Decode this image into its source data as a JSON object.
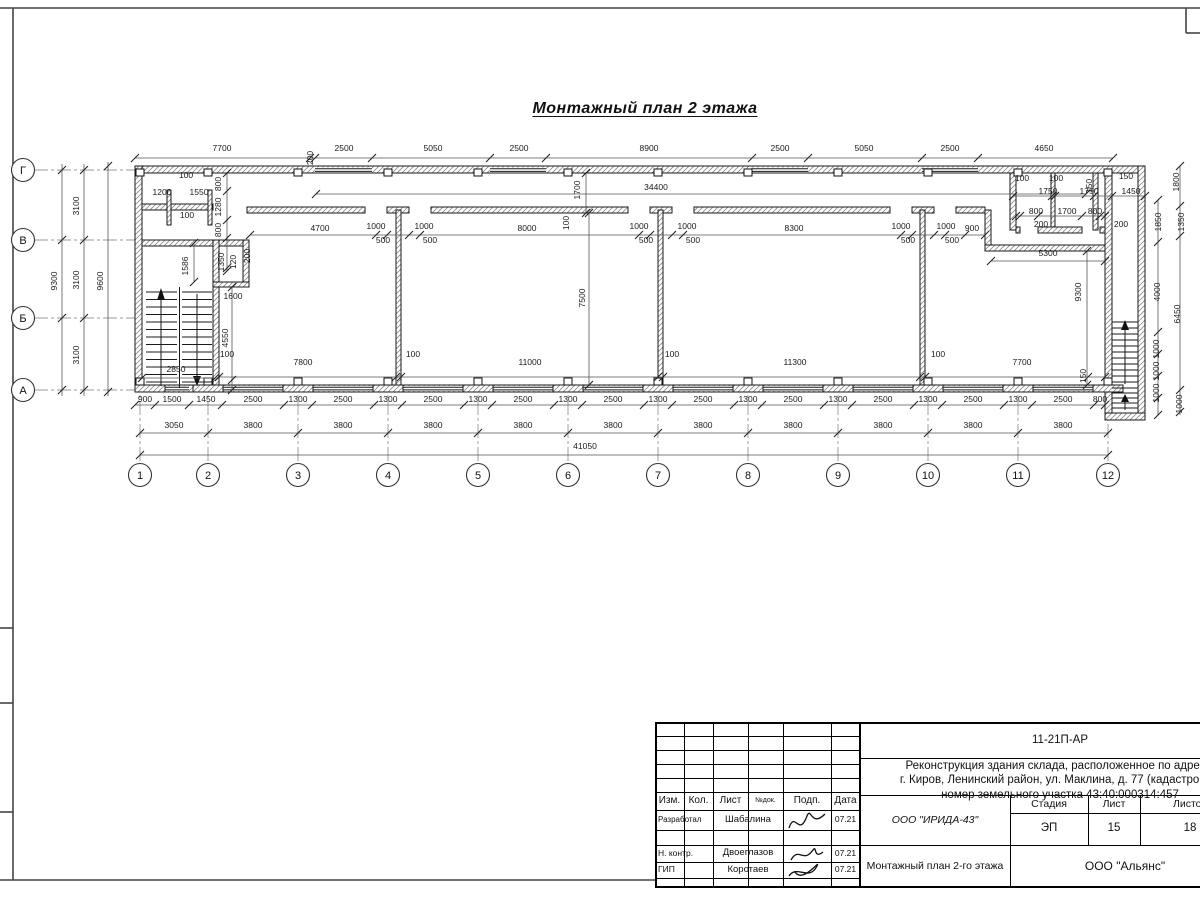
{
  "page": {
    "plan_title": "Монтажный план 2 этажа"
  },
  "plan": {
    "col_axes": [
      {
        "label": "1",
        "x": 140
      },
      {
        "label": "2",
        "x": 208
      },
      {
        "label": "3",
        "x": 298
      },
      {
        "label": "4",
        "x": 388
      },
      {
        "label": "5",
        "x": 478
      },
      {
        "label": "6",
        "x": 568
      },
      {
        "label": "7",
        "x": 658
      },
      {
        "label": "8",
        "x": 748
      },
      {
        "label": "9",
        "x": 838
      },
      {
        "label": "10",
        "x": 928
      },
      {
        "label": "11",
        "x": 1018
      },
      {
        "label": "12",
        "x": 1108
      }
    ],
    "row_axes": [
      {
        "label": "Г",
        "y": 170
      },
      {
        "label": "В",
        "y": 240
      },
      {
        "label": "Б",
        "y": 318
      },
      {
        "label": "А",
        "y": 390
      }
    ],
    "dims": [
      {
        "t": "7700",
        "x": 222,
        "y": 151
      },
      {
        "t": "200",
        "x": 313,
        "y": 158,
        "r": 1
      },
      {
        "t": "2500",
        "x": 344,
        "y": 151
      },
      {
        "t": "5050",
        "x": 433,
        "y": 151
      },
      {
        "t": "2500",
        "x": 519,
        "y": 151
      },
      {
        "t": "8900",
        "x": 649,
        "y": 151
      },
      {
        "t": "2500",
        "x": 780,
        "y": 151
      },
      {
        "t": "5050",
        "x": 864,
        "y": 151
      },
      {
        "t": "2500",
        "x": 950,
        "y": 151
      },
      {
        "t": "4650",
        "x": 1044,
        "y": 151
      },
      {
        "t": "34400",
        "x": 656,
        "y": 190
      },
      {
        "t": "1700",
        "x": 580,
        "y": 190,
        "r": 1
      },
      {
        "t": "100",
        "x": 569,
        "y": 223,
        "r": 1
      },
      {
        "t": "100",
        "x": 186,
        "y": 178
      },
      {
        "t": "1200",
        "x": 162,
        "y": 195
      },
      {
        "t": "1550",
        "x": 199,
        "y": 195
      },
      {
        "t": "100",
        "x": 187,
        "y": 218
      },
      {
        "t": "800",
        "x": 221,
        "y": 184,
        "r": 1
      },
      {
        "t": "1280",
        "x": 221,
        "y": 207,
        "r": 1
      },
      {
        "t": "800",
        "x": 221,
        "y": 230,
        "r": 1
      },
      {
        "t": "1350",
        "x": 224,
        "y": 262,
        "r": 1
      },
      {
        "t": "120",
        "x": 236,
        "y": 262,
        "r": 1
      },
      {
        "t": "200",
        "x": 250,
        "y": 256,
        "r": 1
      },
      {
        "t": "1586",
        "x": 188,
        "y": 266,
        "r": 1
      },
      {
        "t": "1600",
        "x": 233,
        "y": 299
      },
      {
        "t": "4550",
        "x": 228,
        "y": 338,
        "r": 1
      },
      {
        "t": "100",
        "x": 227,
        "y": 357
      },
      {
        "t": "2850",
        "x": 176,
        "y": 372
      },
      {
        "t": "4700",
        "x": 320,
        "y": 231
      },
      {
        "t": "1000",
        "x": 376,
        "y": 229
      },
      {
        "t": "500",
        "x": 383,
        "y": 243
      },
      {
        "t": "1000",
        "x": 424,
        "y": 229
      },
      {
        "t": "500",
        "x": 430,
        "y": 243
      },
      {
        "t": "8000",
        "x": 527,
        "y": 231
      },
      {
        "t": "1000",
        "x": 639,
        "y": 229
      },
      {
        "t": "500",
        "x": 646,
        "y": 243
      },
      {
        "t": "1000",
        "x": 687,
        "y": 229
      },
      {
        "t": "500",
        "x": 693,
        "y": 243
      },
      {
        "t": "8300",
        "x": 794,
        "y": 231
      },
      {
        "t": "1000",
        "x": 901,
        "y": 229
      },
      {
        "t": "500",
        "x": 908,
        "y": 243
      },
      {
        "t": "1000",
        "x": 946,
        "y": 229
      },
      {
        "t": "900",
        "x": 972,
        "y": 231
      },
      {
        "t": "500",
        "x": 952,
        "y": 243
      },
      {
        "t": "100",
        "x": 1022,
        "y": 181
      },
      {
        "t": "100",
        "x": 1056,
        "y": 181
      },
      {
        "t": "150",
        "x": 1092,
        "y": 186,
        "r": 1
      },
      {
        "t": "150",
        "x": 1126,
        "y": 179
      },
      {
        "t": "1750",
        "x": 1048,
        "y": 194
      },
      {
        "t": "1750",
        "x": 1089,
        "y": 194
      },
      {
        "t": "1450",
        "x": 1131,
        "y": 194
      },
      {
        "t": "800",
        "x": 1036,
        "y": 214
      },
      {
        "t": "1700",
        "x": 1067,
        "y": 214
      },
      {
        "t": "800",
        "x": 1095,
        "y": 214
      },
      {
        "t": "200",
        "x": 1041,
        "y": 227
      },
      {
        "t": "200",
        "x": 1121,
        "y": 227
      },
      {
        "t": "1800",
        "x": 1179,
        "y": 182,
        "r": 1
      },
      {
        "t": "1350",
        "x": 1184,
        "y": 222,
        "r": 1
      },
      {
        "t": "1850",
        "x": 1161,
        "y": 222,
        "r": 1
      },
      {
        "t": "4000",
        "x": 1160,
        "y": 292,
        "r": 1
      },
      {
        "t": "6450",
        "x": 1180,
        "y": 314,
        "r": 1
      },
      {
        "t": "1000",
        "x": 1159,
        "y": 349,
        "r": 1
      },
      {
        "t": "1000",
        "x": 1159,
        "y": 371,
        "r": 1
      },
      {
        "t": "1000",
        "x": 1159,
        "y": 393,
        "r": 1
      },
      {
        "t": "1000",
        "x": 1182,
        "y": 404,
        "r": 1
      },
      {
        "t": "5300",
        "x": 1048,
        "y": 256
      },
      {
        "t": "9300",
        "x": 1081,
        "y": 292,
        "r": 1
      },
      {
        "t": "150",
        "x": 1086,
        "y": 376,
        "r": 1
      },
      {
        "t": "7800",
        "x": 303,
        "y": 365
      },
      {
        "t": "100",
        "x": 413,
        "y": 357
      },
      {
        "t": "11000",
        "x": 530,
        "y": 365
      },
      {
        "t": "100",
        "x": 672,
        "y": 357
      },
      {
        "t": "11300",
        "x": 795,
        "y": 365
      },
      {
        "t": "100",
        "x": 938,
        "y": 357
      },
      {
        "t": "7700",
        "x": 1022,
        "y": 365
      },
      {
        "t": "7500",
        "x": 585,
        "y": 298,
        "r": 1
      },
      {
        "t": "9300",
        "x": 57,
        "y": 281,
        "r": 1
      },
      {
        "t": "3100",
        "x": 79,
        "y": 206,
        "r": 1
      },
      {
        "t": "3100",
        "x": 79,
        "y": 280,
        "r": 1
      },
      {
        "t": "3100",
        "x": 79,
        "y": 355,
        "r": 1
      },
      {
        "t": "9600",
        "x": 103,
        "y": 281,
        "r": 1
      },
      {
        "t": "900",
        "x": 145,
        "y": 402
      },
      {
        "t": "1500",
        "x": 172,
        "y": 402
      },
      {
        "t": "1450",
        "x": 206,
        "y": 402
      },
      {
        "t": "2500",
        "x": 253,
        "y": 402
      },
      {
        "t": "1300",
        "x": 298,
        "y": 402
      },
      {
        "t": "2500",
        "x": 343,
        "y": 402
      },
      {
        "t": "1300",
        "x": 388,
        "y": 402
      },
      {
        "t": "2500",
        "x": 433,
        "y": 402
      },
      {
        "t": "1300",
        "x": 478,
        "y": 402
      },
      {
        "t": "2500",
        "x": 523,
        "y": 402
      },
      {
        "t": "1300",
        "x": 568,
        "y": 402
      },
      {
        "t": "2500",
        "x": 613,
        "y": 402
      },
      {
        "t": "1300",
        "x": 658,
        "y": 402
      },
      {
        "t": "2500",
        "x": 703,
        "y": 402
      },
      {
        "t": "1300",
        "x": 748,
        "y": 402
      },
      {
        "t": "2500",
        "x": 793,
        "y": 402
      },
      {
        "t": "1300",
        "x": 838,
        "y": 402
      },
      {
        "t": "2500",
        "x": 883,
        "y": 402
      },
      {
        "t": "1300",
        "x": 928,
        "y": 402
      },
      {
        "t": "2500",
        "x": 973,
        "y": 402
      },
      {
        "t": "1300",
        "x": 1018,
        "y": 402
      },
      {
        "t": "2500",
        "x": 1063,
        "y": 402
      },
      {
        "t": "800",
        "x": 1100,
        "y": 402
      },
      {
        "t": "3050",
        "x": 174,
        "y": 428
      },
      {
        "t": "3800",
        "x": 253,
        "y": 428
      },
      {
        "t": "3800",
        "x": 343,
        "y": 428
      },
      {
        "t": "3800",
        "x": 433,
        "y": 428
      },
      {
        "t": "3800",
        "x": 523,
        "y": 428
      },
      {
        "t": "3800",
        "x": 613,
        "y": 428
      },
      {
        "t": "3800",
        "x": 703,
        "y": 428
      },
      {
        "t": "3800",
        "x": 793,
        "y": 428
      },
      {
        "t": "3800",
        "x": 883,
        "y": 428
      },
      {
        "t": "3800",
        "x": 973,
        "y": 428
      },
      {
        "t": "3800",
        "x": 1063,
        "y": 428
      },
      {
        "t": "41050",
        "x": 585,
        "y": 449
      }
    ]
  },
  "title_block": {
    "doc_code": "11-21П-АР",
    "project_name_lines": [
      "Реконструкция здания склада, расположенное по адресу:",
      "г. Киров, Ленинский район, ул. Маклина, д. 77 (кадастровый",
      "номер земельного участка 43:40:000314:457"
    ],
    "columns": {
      "izm": "Изм.",
      "kol": "Кол.",
      "list": "Лист",
      "ndok": "№док.",
      "podp": "Подп.",
      "data": "Дата"
    },
    "signature_rows": [
      {
        "role": "Разработал",
        "name": "Шабалина",
        "date": "07.21"
      },
      {
        "role": "Н. контр.",
        "name": "Двоеглазов",
        "date": "07.21"
      },
      {
        "role": "ГИП",
        "name": "Коротаев",
        "date": "07.21"
      }
    ],
    "designer_org": "ООО \"ИРИДА-43\"",
    "stage": {
      "label": "Стадия",
      "value": "ЭП"
    },
    "sheet": {
      "label": "Лист",
      "value": "15"
    },
    "sheets": {
      "label": "Листов",
      "value": "18"
    },
    "drawing_name": "Монтажный план 2-го этажа",
    "builder_org": "ООО \"Альянс\""
  }
}
